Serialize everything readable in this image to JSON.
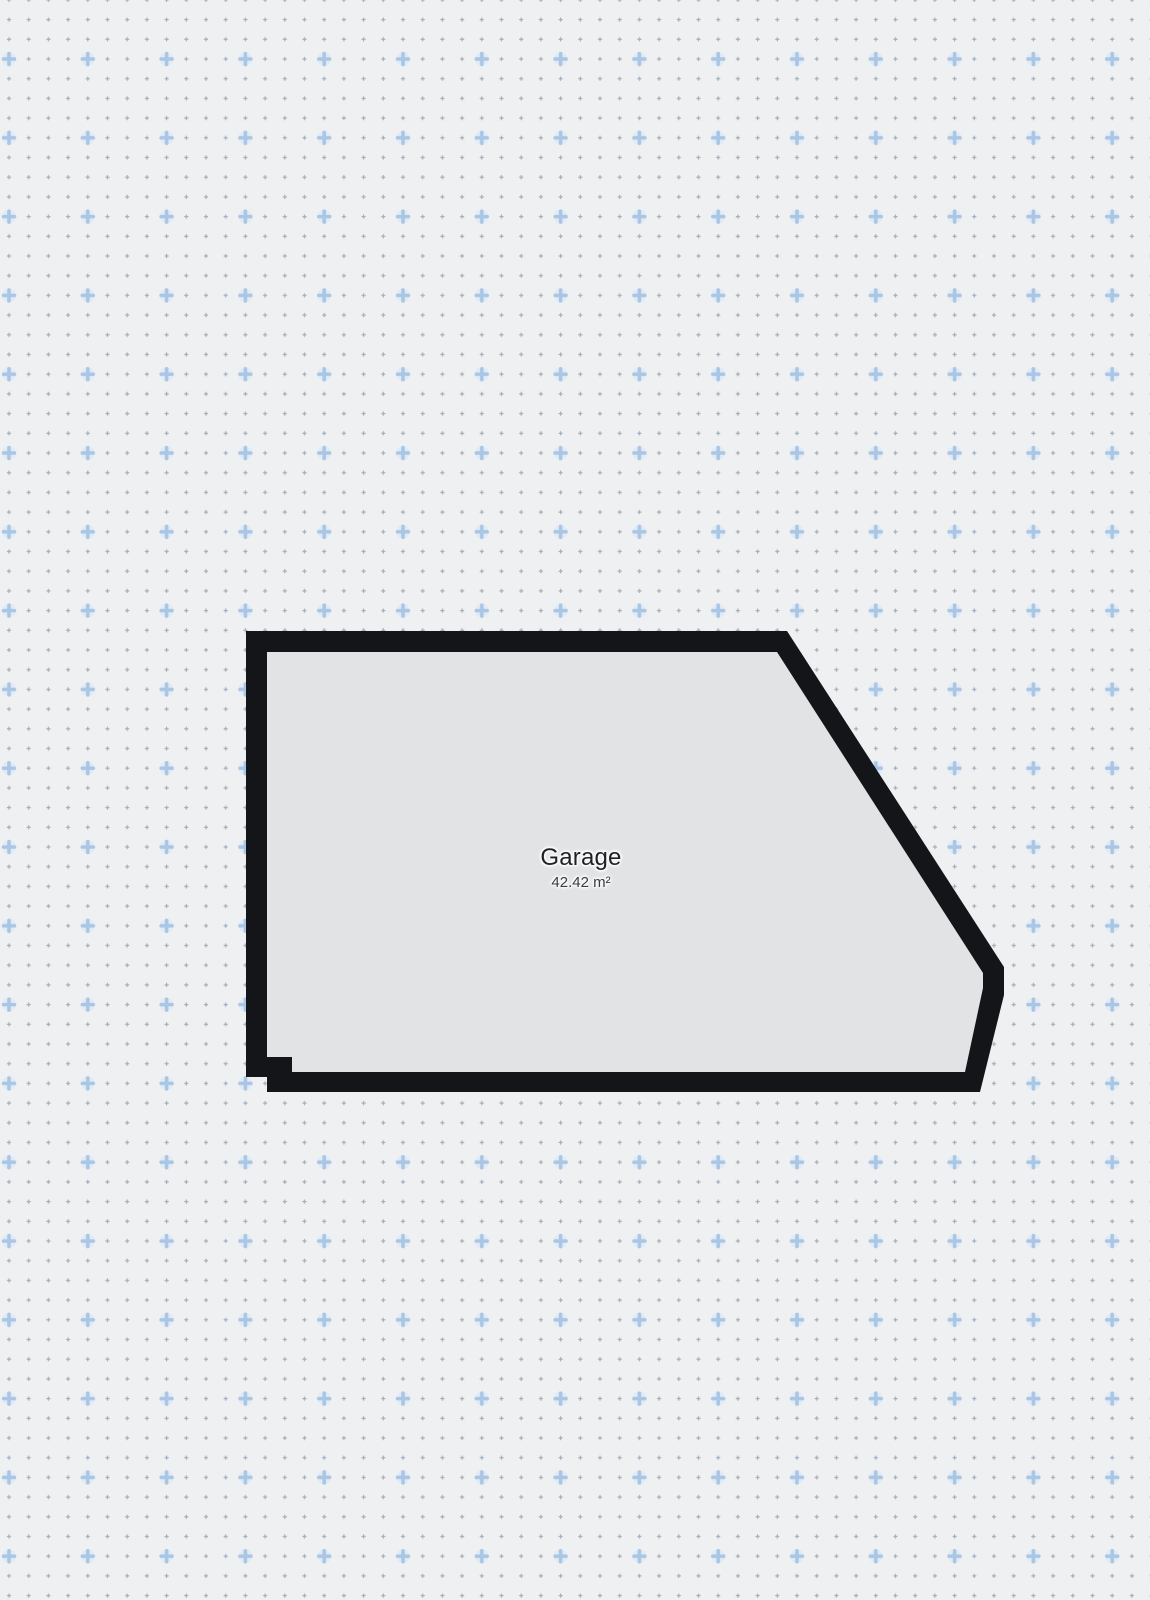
{
  "canvas": {
    "width": "1150",
    "height": "1600",
    "viewbox": "0 0 1150 1600"
  },
  "room": {
    "name": "Garage",
    "area": "42.42 m²",
    "outer_points": "246,631 787,631 1004,967 1004,995 980,1092 267,1092 267,1077 246,1077",
    "inner_points": "267,652 777,652 983,973 983,988 965,1072 292,1072 292,1057 267,1057"
  },
  "grid": {
    "dot_spacing_px": "19.7",
    "plus_spacing_px": "78.8"
  },
  "colors": {
    "background": "#eff0f2",
    "floor": "#e2e3e5",
    "wall": "#141518",
    "grid_dot": "#a6afb9",
    "grid_plus": "#a9c6e4",
    "grid_plus_halo": "#e2ebf5"
  }
}
